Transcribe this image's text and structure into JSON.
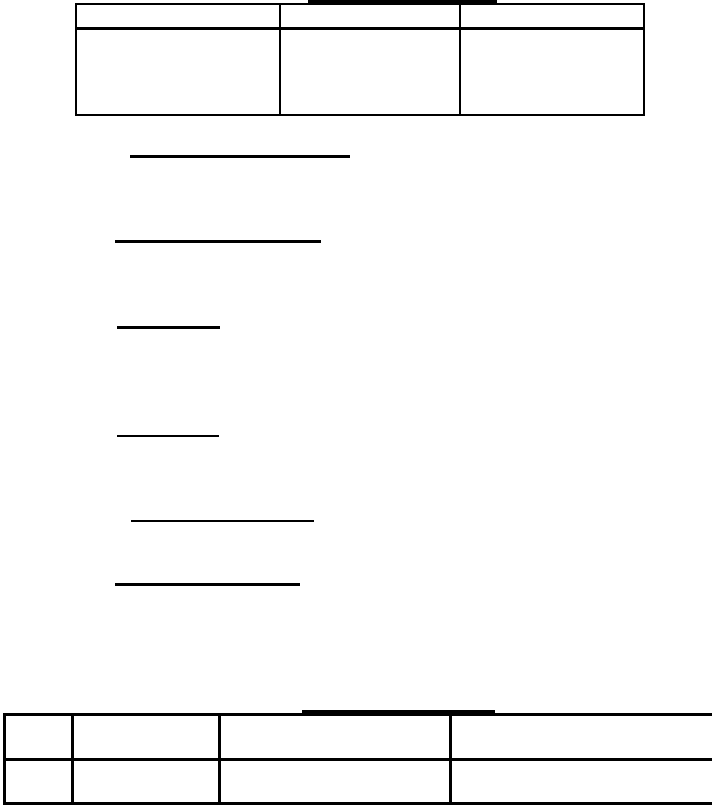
{
  "page": {
    "background_color": "#ffffff",
    "ink_color": "#000000",
    "kind": "blank document form page"
  },
  "top_heading": {
    "underline_bar": "heading-underline",
    "text": ""
  },
  "top_table": {
    "columns": 3,
    "rows": 2,
    "header_cells": [
      "",
      "",
      ""
    ],
    "body_cells": [
      "",
      "",
      ""
    ]
  },
  "blank_field_underlines": [
    {
      "id": 1,
      "text_above": "",
      "weight": "bold"
    },
    {
      "id": 2,
      "text_above": "",
      "weight": "bold"
    },
    {
      "id": 3,
      "text_above": "",
      "weight": "bold"
    },
    {
      "id": 4,
      "text_above": "",
      "weight": "thin"
    },
    {
      "id": 5,
      "text_above": "",
      "weight": "thin"
    },
    {
      "id": 6,
      "text_above": "",
      "weight": "bold"
    }
  ],
  "bottom_heading": {
    "underline_bar": "heading-underline",
    "text": ""
  },
  "bottom_table": {
    "columns": 4,
    "rows": 2,
    "header_cells": [
      "",
      "",
      "",
      ""
    ],
    "body_cells": [
      "",
      "",
      "",
      ""
    ]
  }
}
